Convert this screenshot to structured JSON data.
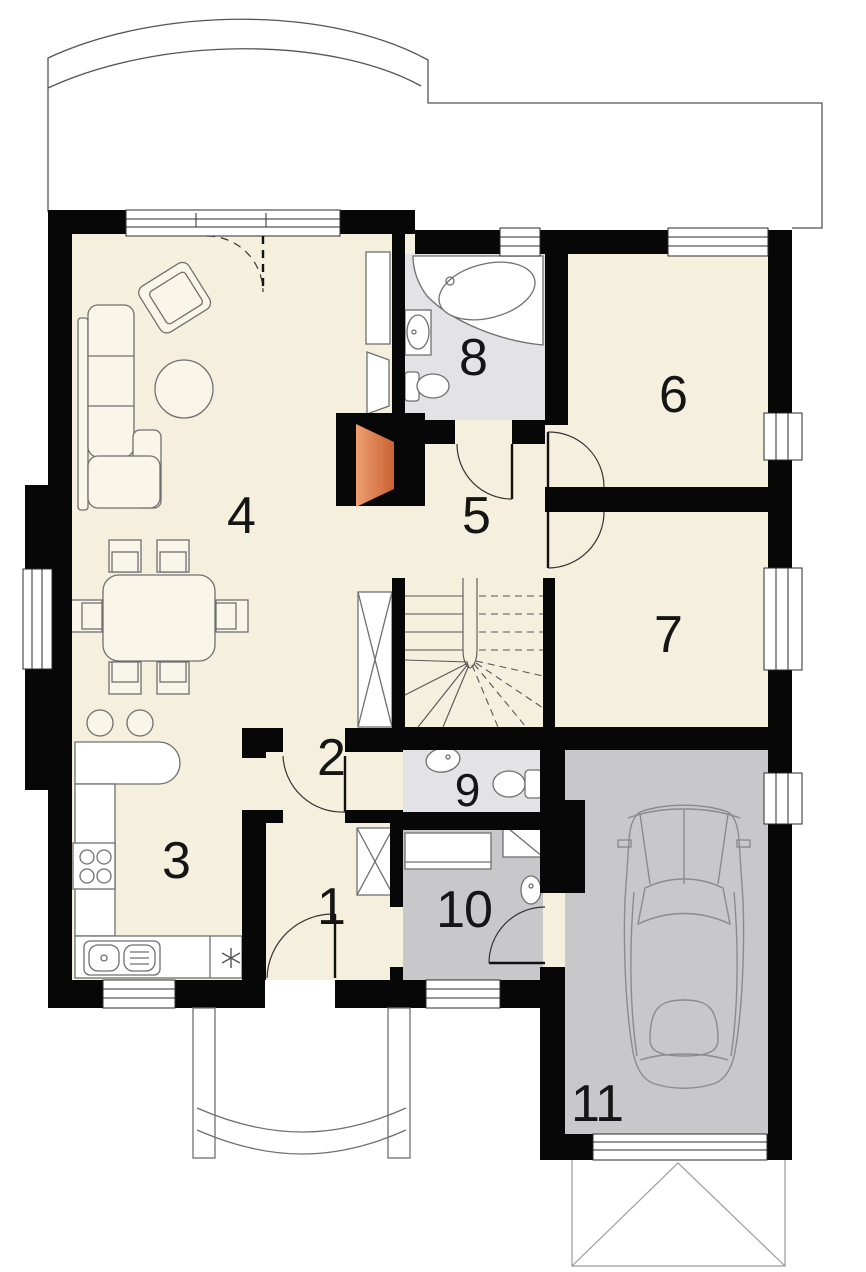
{
  "plan": {
    "type": "house-ground-floor-plan",
    "rooms": [
      {
        "number": "1"
      },
      {
        "number": "2"
      },
      {
        "number": "3"
      },
      {
        "number": "4"
      },
      {
        "number": "5"
      },
      {
        "number": "6"
      },
      {
        "number": "7"
      },
      {
        "number": "8"
      },
      {
        "number": "9"
      },
      {
        "number": "10"
      },
      {
        "number": "11"
      }
    ],
    "colors": {
      "wall": "#070707",
      "floor": "#f5f0de",
      "bath_floor": "#e3e3e6",
      "utility_floor": "#c8c8ca",
      "fireplace_light": "#ef9f70",
      "fireplace_dark": "#c86233",
      "outline": "#6f6f6f",
      "furniture_fill": "#f9f5e8"
    }
  }
}
